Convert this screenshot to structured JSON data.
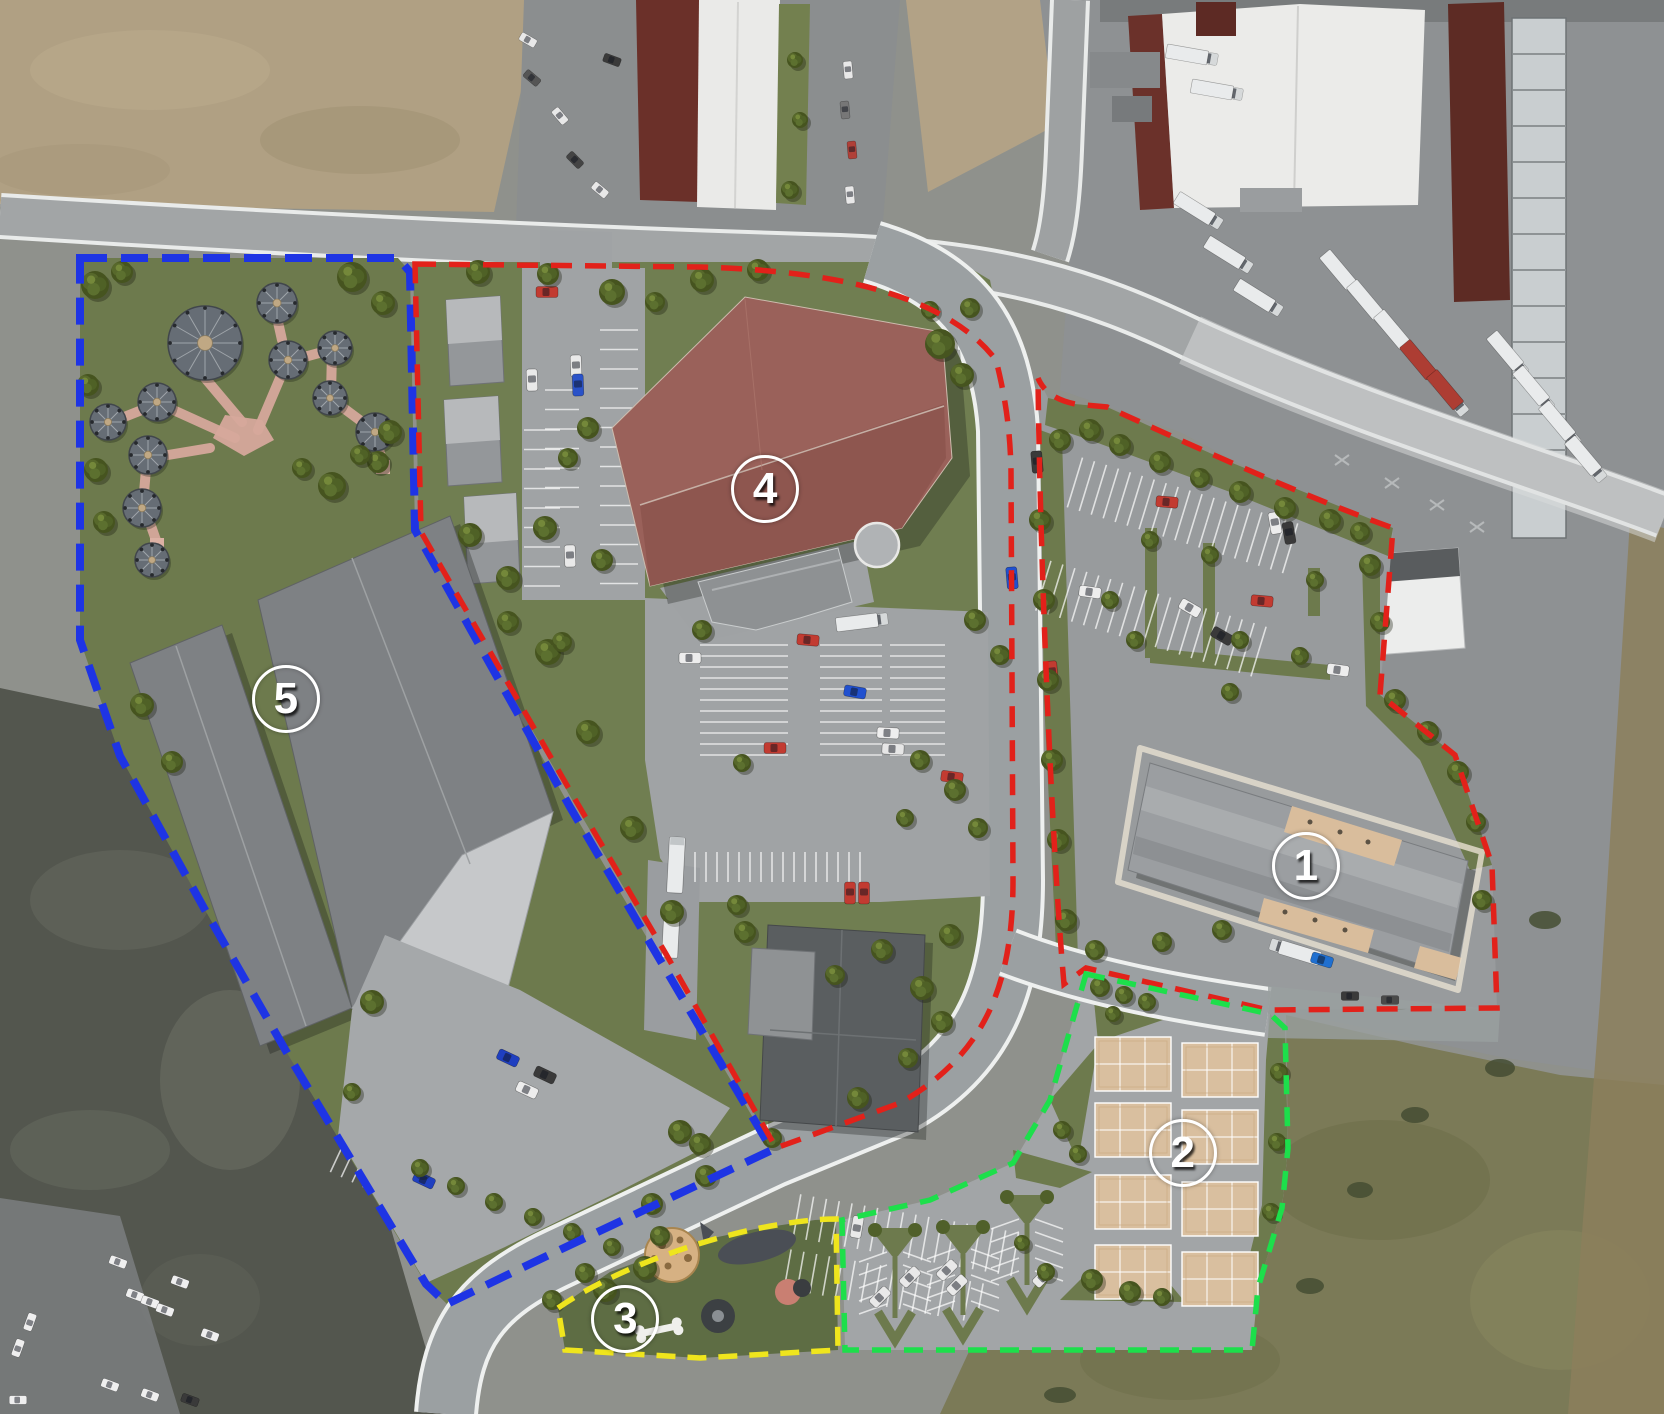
{
  "map": {
    "view_label": "Aerial site master plan with numbered development zones",
    "marker_style": {
      "ring_color": "#ffffff",
      "number_color": "#ffffff"
    },
    "zones": [
      {
        "number": "1",
        "boundary_color": "#e2211a",
        "boundary_style": "dashed",
        "marker": {
          "x_pct": 78.3,
          "y_pct": 61.0
        }
      },
      {
        "number": "2",
        "boundary_color": "#1ddf4b",
        "boundary_style": "dashed",
        "marker": {
          "x_pct": 70.9,
          "y_pct": 81.3
        }
      },
      {
        "number": "3",
        "boundary_color": "#efe51d",
        "boundary_style": "dashed",
        "marker": {
          "x_pct": 37.4,
          "y_pct": 93.1
        }
      },
      {
        "number": "4",
        "boundary_color": "#e2211a",
        "boundary_style": "dashed",
        "marker": {
          "x_pct": 45.8,
          "y_pct": 34.4
        }
      },
      {
        "number": "5",
        "boundary_color": "#1e34e4",
        "boundary_style": "dashed",
        "marker": {
          "x_pct": 17.0,
          "y_pct": 49.2
        }
      }
    ]
  }
}
